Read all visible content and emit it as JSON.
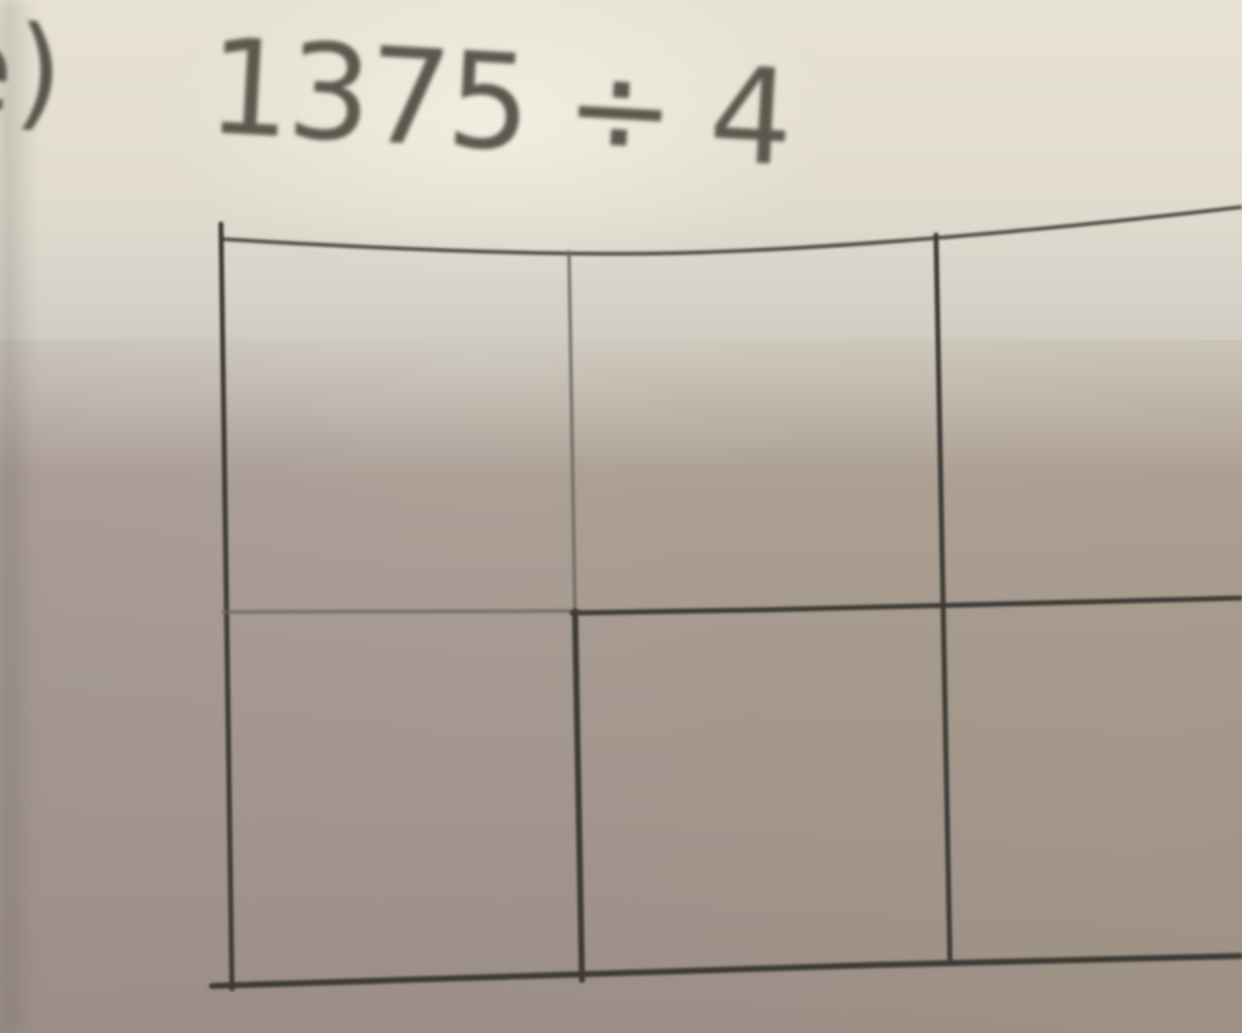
{
  "problem": {
    "label": "e)",
    "expression": "1375 ÷ 4",
    "dividend": "1375",
    "operator": "÷",
    "divisor": "4"
  },
  "worksheet_grid": {
    "rows": 2,
    "columns": 3,
    "cells": [
      [
        "",
        "",
        ""
      ],
      [
        "",
        "",
        ""
      ]
    ],
    "note_right_column_cropped": "third column runs off the right edge of the photo"
  },
  "colors": {
    "ink": "#3e3b36",
    "ink_light": "#6b675f",
    "text_ink": "#5d574e",
    "paper_top": "#e7e2d4",
    "paper_bottom": "#9b8e88"
  }
}
